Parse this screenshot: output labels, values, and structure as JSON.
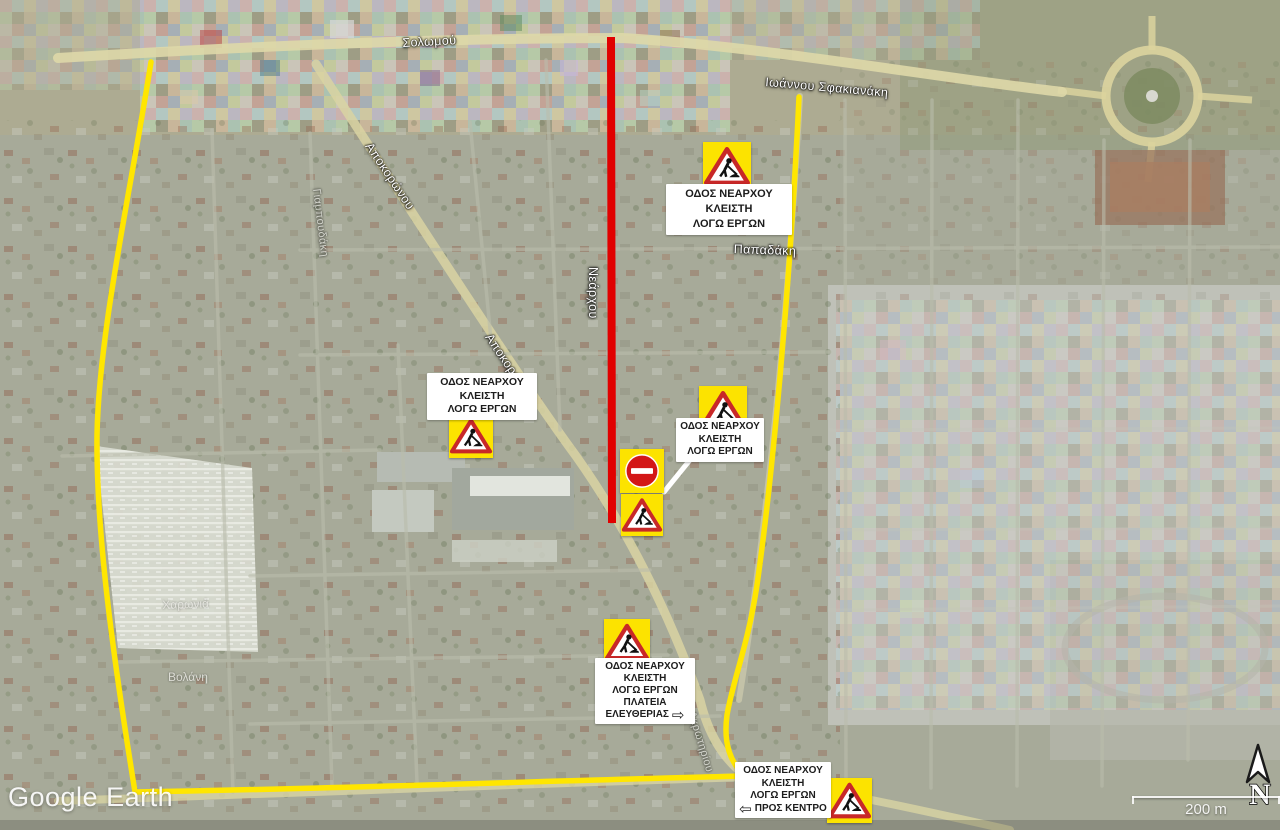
{
  "watermark": {
    "text": "Google Earth"
  },
  "map_controls": {
    "north_label": "N",
    "scale_label": "200 m"
  },
  "closure_signs": {
    "north": {
      "lines": [
        "ΟΔΟΣ ΝΕΑΡΧΟΥ",
        "ΚΛΕΙΣΤΗ",
        "ΛΟΓΩ ΕΡΓΩΝ"
      ]
    },
    "west": {
      "lines": [
        "ΟΔΟΣ ΝΕΑΡΧΟΥ",
        "ΚΛΕΙΣΤΗ",
        "ΛΟΓΩ ΕΡΓΩΝ"
      ]
    },
    "mid": {
      "lines": [
        "ΟΔΟΣ ΝΕΑΡΧΟΥ",
        "ΚΛΕΙΣΤΗ",
        "ΛΟΓΩ ΕΡΓΩΝ"
      ]
    },
    "south": {
      "lines": [
        "ΟΔΟΣ ΝΕΑΡΧΟΥ",
        "ΚΛΕΙΣΤΗ",
        "ΛΟΓΩ ΕΡΓΩΝ",
        "ΠΛΑΤΕΙΑ"
      ],
      "last_line": "ΕΛΕΥΘΕΡΙΑΣ",
      "arrow": "⇨"
    },
    "southeast": {
      "lines": [
        "ΟΔΟΣ ΝΕΑΡΧΟΥ",
        "ΚΛΕΙΣΤΗ",
        "ΛΟΓΩ ΕΡΓΩΝ"
      ],
      "arrow": "⇦",
      "last_line": "ΠΡΟΣ ΚΕΝΤΡΟ"
    }
  },
  "street_labels": {
    "solomou": "Σολωμού",
    "sfakianaki": "Ιωάννου Σφακιανάκη",
    "papadaki": "Παπαδάκη",
    "nearchou": "Νεάρχου",
    "apokoronou_upper": "Αποκορώνου",
    "apokoronou_lower": "Αποκορώνου",
    "giampoudaki": "Γιαμπουδάκη",
    "akrotiriou": "Ακρωτηρίου",
    "charonia": "Χαρωνιά",
    "volani": "Βολάνη"
  },
  "colors": {
    "closed_road_red": "#e10000",
    "detour_route_yellow": "#ffe600",
    "sign_background_yellow": "#fce300",
    "sign_triangle_border_red": "#c82828",
    "no_entry_red": "#d31717",
    "label_background": "#ffffff",
    "label_text": "#1c1c1c"
  }
}
